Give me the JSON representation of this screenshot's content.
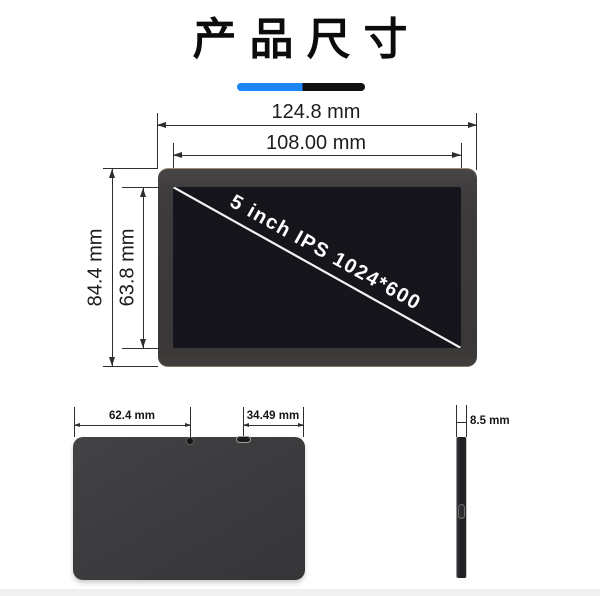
{
  "title": {
    "text": "产品尺寸"
  },
  "colors": {
    "accent_blue": "#1d86f7",
    "accent_black": "#101010"
  },
  "front_view": {
    "screen_label": "5 inch IPS 1024*600",
    "outer_width": "124.8 mm",
    "screen_width": "108.00 mm",
    "outer_height": "84.4 mm",
    "screen_height": "63.8 mm"
  },
  "back_view": {
    "width_left": "62.4 mm",
    "width_right": "34.49 mm"
  },
  "side_view": {
    "thickness": "8.5 mm"
  }
}
